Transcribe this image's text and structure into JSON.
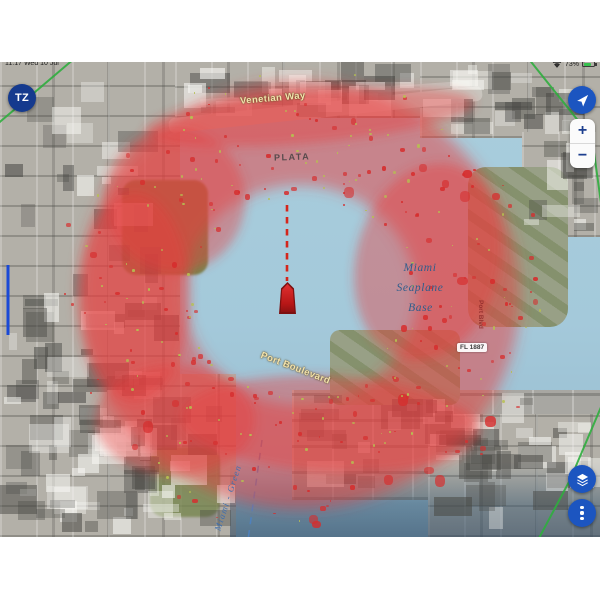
{
  "status_bar": {
    "datetime": "11:17 Wed 10 Jul",
    "battery_percent": "73%"
  },
  "nav_controls": {
    "tz_logo": "TZ",
    "zoom_in": "+",
    "zoom_out": "−"
  },
  "map": {
    "labels": {
      "road_venetian": "Venetian Way",
      "road_plata": "PLATA",
      "road_port_boulevard": "Port Boulevard",
      "road_port_vertical": "Port Blvd",
      "seaplane_line1": "Miami",
      "seaplane_line2": "Seaplane",
      "seaplane_line3": "Base",
      "channel": "Miami - Green",
      "light_marker": "FL 1887"
    },
    "colors": {
      "restricted_zone_red": "#e83e3e",
      "water_blue": "#a6cbdb",
      "accent_button_blue": "#1c55c0",
      "tz_logo_navy": "#153a8e",
      "track_green": "#2fae3e",
      "own_ship_red": "#c21f1f"
    },
    "icons": {
      "locate": "navigation-arrow",
      "layers": "map-layers",
      "more": "vertical-ellipsis",
      "wifi": "wifi",
      "battery": "battery"
    }
  }
}
